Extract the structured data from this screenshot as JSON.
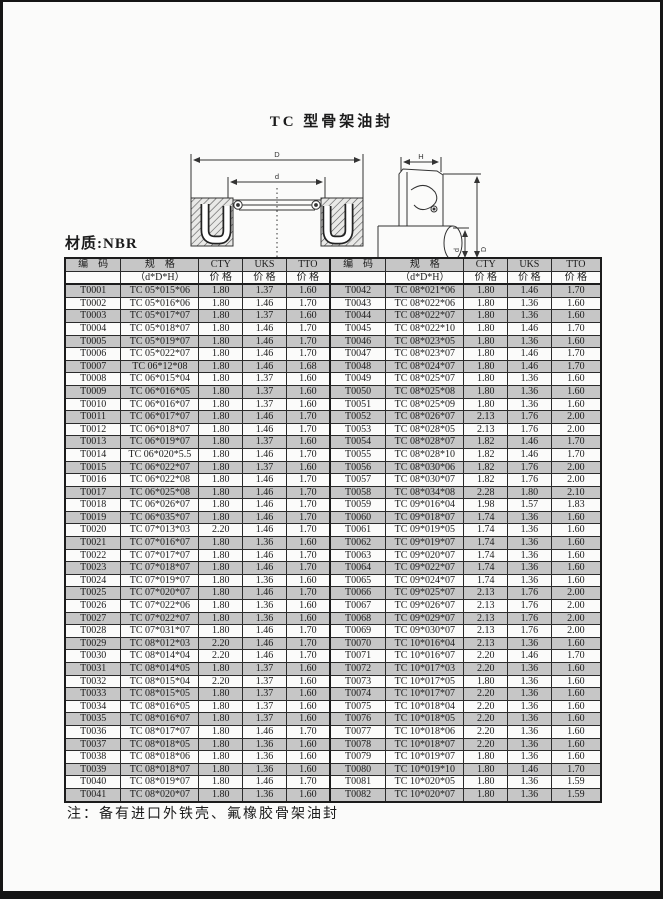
{
  "page": {
    "title": "TC 型骨架油封",
    "material_label": "材质:NBR",
    "note": "注：备有进口外铁壳、氟橡胶骨架油封"
  },
  "diagram": {
    "labels": {
      "front_outer_diameter": "D",
      "front_inner_diameter": "d",
      "side_height": "H",
      "side_shaft_diameter": "d",
      "side_outer_diameter": "D"
    }
  },
  "table": {
    "headers": {
      "code": "编　码",
      "spec": "规　格",
      "spec_sub": "（d*D*H）",
      "cty": "CTY",
      "uks": "UKS",
      "tto": "TTO",
      "price": "价 格"
    },
    "rows_left": [
      [
        "T0001",
        "TC 05*015*06",
        "1.80",
        "1.37",
        "1.60"
      ],
      [
        "T0002",
        "TC 05*016*06",
        "1.80",
        "1.46",
        "1.70"
      ],
      [
        "T0003",
        "TC 05*017*07",
        "1.80",
        "1.37",
        "1.60"
      ],
      [
        "T0004",
        "TC 05*018*07",
        "1.80",
        "1.46",
        "1.70"
      ],
      [
        "T0005",
        "TC 05*019*07",
        "1.80",
        "1.46",
        "1.70"
      ],
      [
        "T0006",
        "TC 05*022*07",
        "1.80",
        "1.46",
        "1.70"
      ],
      [
        "T0007",
        "TC 06*12*08",
        "1.80",
        "1.46",
        "1.68"
      ],
      [
        "T0008",
        "TC 06*015*04",
        "1.80",
        "1.37",
        "1.60"
      ],
      [
        "T0009",
        "TC 06*016*05",
        "1.80",
        "1.37",
        "1.60"
      ],
      [
        "T0010",
        "TC 06*016*07",
        "1.80",
        "1.37",
        "1.60"
      ],
      [
        "T0011",
        "TC 06*017*07",
        "1.80",
        "1.46",
        "1.70"
      ],
      [
        "T0012",
        "TC 06*018*07",
        "1.80",
        "1.46",
        "1.70"
      ],
      [
        "T0013",
        "TC 06*019*07",
        "1.80",
        "1.37",
        "1.60"
      ],
      [
        "T0014",
        "TC 06*020*5.5",
        "1.80",
        "1.46",
        "1.70"
      ],
      [
        "T0015",
        "TC 06*022*07",
        "1.80",
        "1.37",
        "1.60"
      ],
      [
        "T0016",
        "TC 06*022*08",
        "1.80",
        "1.46",
        "1.70"
      ],
      [
        "T0017",
        "TC 06*025*08",
        "1.80",
        "1.46",
        "1.70"
      ],
      [
        "T0018",
        "TC 06*026*07",
        "1.80",
        "1.46",
        "1.70"
      ],
      [
        "T0019",
        "TC 06*035*07",
        "1.80",
        "1.46",
        "1.70"
      ],
      [
        "T0020",
        "TC 07*013*03",
        "2.20",
        "1.46",
        "1.70"
      ],
      [
        "T0021",
        "TC 07*016*07",
        "1.80",
        "1.36",
        "1.60"
      ],
      [
        "T0022",
        "TC 07*017*07",
        "1.80",
        "1.46",
        "1.70"
      ],
      [
        "T0023",
        "TC 07*018*07",
        "1.80",
        "1.46",
        "1.70"
      ],
      [
        "T0024",
        "TC 07*019*07",
        "1.80",
        "1.36",
        "1.60"
      ],
      [
        "T0025",
        "TC 07*020*07",
        "1.80",
        "1.46",
        "1.70"
      ],
      [
        "T0026",
        "TC 07*022*06",
        "1.80",
        "1.36",
        "1.60"
      ],
      [
        "T0027",
        "TC 07*022*07",
        "1.80",
        "1.36",
        "1.60"
      ],
      [
        "T0028",
        "TC 07*031*07",
        "1.80",
        "1.46",
        "1.70"
      ],
      [
        "T0029",
        "TC 08*012*03",
        "2.20",
        "1.46",
        "1.70"
      ],
      [
        "T0030",
        "TC 08*014*04",
        "2.20",
        "1.46",
        "1.70"
      ],
      [
        "T0031",
        "TC 08*014*05",
        "1.80",
        "1.37",
        "1.60"
      ],
      [
        "T0032",
        "TC 08*015*04",
        "2.20",
        "1.37",
        "1.60"
      ],
      [
        "T0033",
        "TC 08*015*05",
        "1.80",
        "1.37",
        "1.60"
      ],
      [
        "T0034",
        "TC 08*016*05",
        "1.80",
        "1.37",
        "1.60"
      ],
      [
        "T0035",
        "TC 08*016*07",
        "1.80",
        "1.37",
        "1.60"
      ],
      [
        "T0036",
        "TC 08*017*07",
        "1.80",
        "1.46",
        "1.70"
      ],
      [
        "T0037",
        "TC 08*018*05",
        "1.80",
        "1.36",
        "1.60"
      ],
      [
        "T0038",
        "TC 08*018*06",
        "1.80",
        "1.36",
        "1.60"
      ],
      [
        "T0039",
        "TC 08*018*07",
        "1.80",
        "1.36",
        "1.60"
      ],
      [
        "T0040",
        "TC 08*019*07",
        "1.80",
        "1.46",
        "1.70"
      ],
      [
        "T0041",
        "TC 08*020*07",
        "1.80",
        "1.36",
        "1.60"
      ]
    ],
    "rows_right": [
      [
        "T0042",
        "TC 08*021*06",
        "1.80",
        "1.46",
        "1.70"
      ],
      [
        "T0043",
        "TC 08*022*06",
        "1.80",
        "1.36",
        "1.60"
      ],
      [
        "T0044",
        "TC 08*022*07",
        "1.80",
        "1.36",
        "1.60"
      ],
      [
        "T0045",
        "TC 08*022*10",
        "1.80",
        "1.46",
        "1.70"
      ],
      [
        "T0046",
        "TC 08*023*05",
        "1.80",
        "1.36",
        "1.60"
      ],
      [
        "T0047",
        "TC 08*023*07",
        "1.80",
        "1.46",
        "1.70"
      ],
      [
        "T0048",
        "TC 08*024*07",
        "1.80",
        "1.46",
        "1.70"
      ],
      [
        "T0049",
        "TC 08*025*07",
        "1.80",
        "1.36",
        "1.60"
      ],
      [
        "T0050",
        "TC 08*025*08",
        "1.80",
        "1.36",
        "1.60"
      ],
      [
        "T0051",
        "TC 08*025*09",
        "1.80",
        "1.36",
        "1.60"
      ],
      [
        "T0052",
        "TC 08*026*07",
        "2.13",
        "1.76",
        "2.00"
      ],
      [
        "T0053",
        "TC 08*028*05",
        "2.13",
        "1.76",
        "2.00"
      ],
      [
        "T0054",
        "TC 08*028*07",
        "1.82",
        "1.46",
        "1.70"
      ],
      [
        "T0055",
        "TC 08*028*10",
        "1.82",
        "1.46",
        "1.70"
      ],
      [
        "T0056",
        "TC 08*030*06",
        "1.82",
        "1.76",
        "2.00"
      ],
      [
        "T0057",
        "TC 08*030*07",
        "1.82",
        "1.76",
        "2.00"
      ],
      [
        "T0058",
        "TC 08*034*08",
        "2.28",
        "1.80",
        "2.10"
      ],
      [
        "T0059",
        "TC 09*016*04",
        "1.98",
        "1.57",
        "1.83"
      ],
      [
        "T0060",
        "TC 09*018*07",
        "1.74",
        "1.36",
        "1.60"
      ],
      [
        "T0061",
        "TC 09*019*05",
        "1.74",
        "1.36",
        "1.60"
      ],
      [
        "T0062",
        "TC 09*019*07",
        "1.74",
        "1.36",
        "1.60"
      ],
      [
        "T0063",
        "TC 09*020*07",
        "1.74",
        "1.36",
        "1.60"
      ],
      [
        "T0064",
        "TC 09*022*07",
        "1.74",
        "1.36",
        "1.60"
      ],
      [
        "T0065",
        "TC 09*024*07",
        "1.74",
        "1.36",
        "1.60"
      ],
      [
        "T0066",
        "TC 09*025*07",
        "2.13",
        "1.76",
        "2.00"
      ],
      [
        "T0067",
        "TC 09*026*07",
        "2.13",
        "1.76",
        "2.00"
      ],
      [
        "T0068",
        "TC 09*029*07",
        "2.13",
        "1.76",
        "2.00"
      ],
      [
        "T0069",
        "TC 09*030*07",
        "2.13",
        "1.76",
        "2.00"
      ],
      [
        "T0070",
        "TC 10*016*04",
        "2.13",
        "1.36",
        "1.60"
      ],
      [
        "T0071",
        "TC 10*016*07",
        "2.20",
        "1.46",
        "1.70"
      ],
      [
        "T0072",
        "TC 10*017*03",
        "2.20",
        "1.36",
        "1.60"
      ],
      [
        "T0073",
        "TC 10*017*05",
        "1.80",
        "1.36",
        "1.60"
      ],
      [
        "T0074",
        "TC 10*017*07",
        "2.20",
        "1.36",
        "1.60"
      ],
      [
        "T0075",
        "TC 10*018*04",
        "2.20",
        "1.36",
        "1.60"
      ],
      [
        "T0076",
        "TC 10*018*05",
        "2.20",
        "1.36",
        "1.60"
      ],
      [
        "T0077",
        "TC 10*018*06",
        "2.20",
        "1.36",
        "1.60"
      ],
      [
        "T0078",
        "TC 10*018*07",
        "2.20",
        "1.36",
        "1.60"
      ],
      [
        "T0079",
        "TC 10*019*07",
        "1.80",
        "1.36",
        "1.60"
      ],
      [
        "T0080",
        "TC 10*019*10",
        "1.80",
        "1.46",
        "1.70"
      ],
      [
        "T0081",
        "TC 10*020*05",
        "1.80",
        "1.36",
        "1.59"
      ],
      [
        "T0082",
        "TC 10*020*07",
        "1.80",
        "1.36",
        "1.59"
      ]
    ]
  }
}
